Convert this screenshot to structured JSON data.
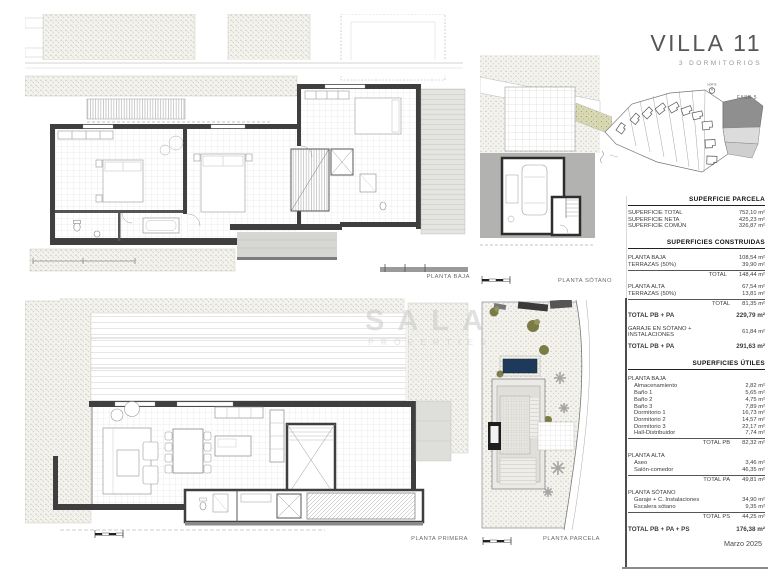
{
  "header": {
    "title": "VILLA 11",
    "subtitle": "3 DORMITORIOS"
  },
  "site_map": {
    "fase_label": "FASE 5",
    "north_label": "NORTE"
  },
  "plan_labels": {
    "baja": "PLANTA BAJA",
    "sotano": "PLANTA SÓTANO",
    "primera": "PLANTA PRIMERA",
    "parcela": "PLANTA PARCELA"
  },
  "watermark": {
    "line1": "SALA",
    "line2": "PROPERTIES"
  },
  "tables": {
    "parcela": {
      "header": "SUPERFICIE PARCELA",
      "rows": [
        {
          "label": "SUPERFICIE TOTAL",
          "value": "752,10 m²"
        },
        {
          "label": "SUPERFICIE NETA",
          "value": "425,23 m²"
        },
        {
          "label": "SUPERFICIE COMÚN",
          "value": "326,87 m²"
        }
      ]
    },
    "construidas": {
      "header": "SUPERFICIES CONSTRUIDAS",
      "rows": [
        {
          "label": "PLANTA BAJA",
          "value": "108,54 m²",
          "cls": "gap"
        },
        {
          "label": "TERRAZAS (50%)",
          "value": "39,90 m²"
        },
        {
          "label": "TOTAL",
          "value": "148,44 m²",
          "cls": "total"
        },
        {
          "label": "PLANTA ALTA",
          "value": "67,54 m²",
          "cls": "gap"
        },
        {
          "label": "TERRAZAS (50%)",
          "value": "13,81 m²"
        },
        {
          "label": "TOTAL",
          "value": "81,35 m²",
          "cls": "total"
        },
        {
          "label": "TOTAL PB + PA",
          "value": "229,79 m²",
          "cls": "bold"
        },
        {
          "label": "GARAJE EN SÓTANO + INSTALACIONES",
          "value": "61,84 m²",
          "cls": "wrap"
        },
        {
          "label": "TOTAL PB + PA",
          "value": "291,63 m²",
          "cls": "bold"
        }
      ]
    },
    "utiles": {
      "header": "SUPERFICIES ÚTILES",
      "rows": [
        {
          "label": "PLANTA BAJA",
          "cls": "sec"
        },
        {
          "label": "Almacenamiento",
          "value": "2,82 m²",
          "cls": "sub"
        },
        {
          "label": "Baño 1",
          "value": "5,65 m²",
          "cls": "sub"
        },
        {
          "label": "Baño 2",
          "value": "4,75 m²",
          "cls": "sub"
        },
        {
          "label": "Baño 3",
          "value": "7,89 m²",
          "cls": "sub"
        },
        {
          "label": "Dormitorio 1",
          "value": "16,73 m²",
          "cls": "sub"
        },
        {
          "label": "Dormitorio 2",
          "value": "14,57 m²",
          "cls": "sub"
        },
        {
          "label": "Dormitorio 3",
          "value": "22,17 m²",
          "cls": "sub"
        },
        {
          "label": "Hall-Distribuidor",
          "value": "7,74 m²",
          "cls": "sub"
        },
        {
          "label": "TOTAL PB",
          "value": "82,32 m²",
          "cls": "total"
        },
        {
          "label": "PLANTA ALTA",
          "cls": "sec"
        },
        {
          "label": "Aseo",
          "value": "3,46 m²",
          "cls": "sub"
        },
        {
          "label": "Salón-comedor",
          "value": "46,35 m²",
          "cls": "sub"
        },
        {
          "label": "TOTAL PA",
          "value": "49,81 m²",
          "cls": "total"
        },
        {
          "label": "PLANTA SÓTANO",
          "cls": "sec"
        },
        {
          "label": "Garaje + C. Instalaciones",
          "value": "34,90 m²",
          "cls": "sub"
        },
        {
          "label": "Escalera sótano",
          "value": "9,35 m²",
          "cls": "sub"
        },
        {
          "label": "TOTAL PS",
          "value": "44,25 m²",
          "cls": "total"
        },
        {
          "label": "TOTAL PB + PA + PS",
          "value": "176,38 m²",
          "cls": "grand"
        }
      ]
    }
  },
  "footer": {
    "date": "Marzo 2025"
  },
  "colors": {
    "wall": "#3f3f3f",
    "pool": "#1d3a5c",
    "earth": "#b2b2b0",
    "olive": "#7b7b46",
    "fase_dark": "#8f8f8f",
    "stipple_bg": "#f3f2ec"
  }
}
